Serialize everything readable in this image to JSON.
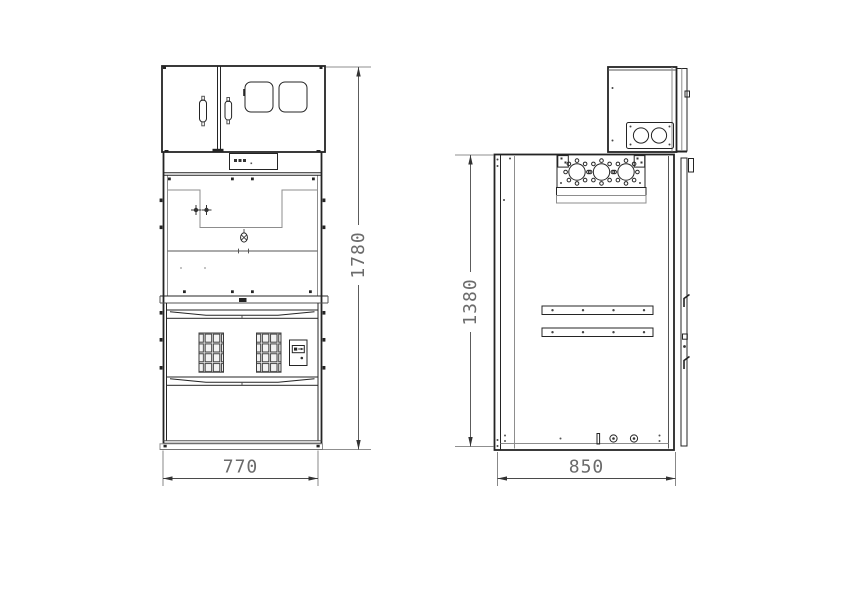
{
  "drawing": {
    "dimensions": {
      "front_width": "770",
      "front_height": "1780",
      "side_depth": "850",
      "side_height": "1380"
    },
    "colors": {
      "line": "#242424",
      "light_line": "#8d8d8d",
      "dimension_text": "#6b6b6b"
    }
  }
}
